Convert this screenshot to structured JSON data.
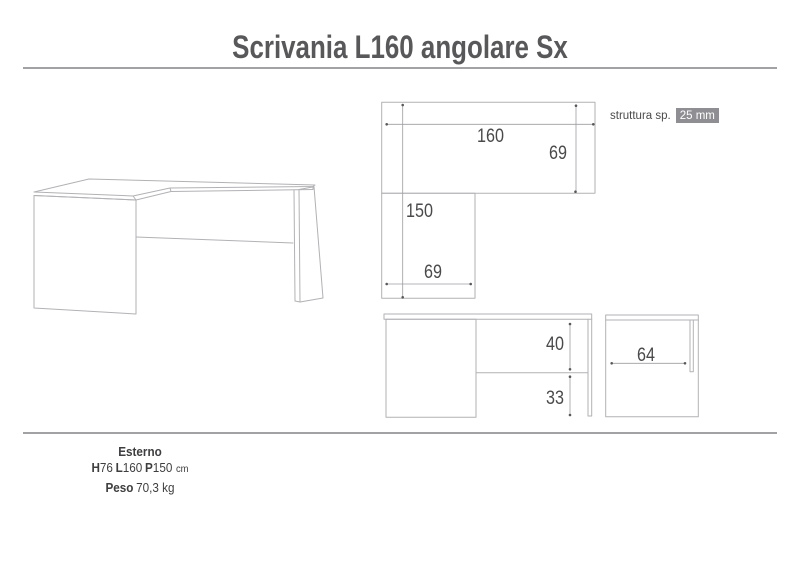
{
  "title": "Scrivania L160 angolare Sx",
  "struttura": {
    "label": "struttura sp.",
    "value": "25 mm"
  },
  "dimensions": {
    "top_view": {
      "width": "160",
      "depth": "69",
      "total_depth": "150",
      "return_width": "69"
    },
    "front_view": {
      "modesty_height": "40",
      "clearance": "33"
    },
    "side_view": {
      "inner_width": "64"
    }
  },
  "specs": {
    "heading": "Esterno",
    "h_label": "H",
    "h_value": "76",
    "l_label": "L",
    "l_value": "160",
    "p_label": "P",
    "p_value": "150",
    "unit": "cm",
    "weight_label": "Peso",
    "weight_value": "70,3 kg"
  },
  "colors": {
    "title_text": "#58585a",
    "rule": "#a2a2a5",
    "drawing_line": "#b2b2b6",
    "dimension_text": "#4a4a4c",
    "highlight_bg": "#8f8f93",
    "highlight_text": "#ffffff"
  }
}
